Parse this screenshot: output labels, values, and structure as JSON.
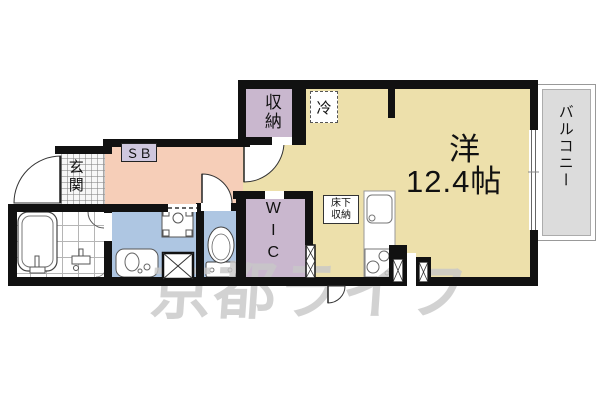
{
  "floorplan": {
    "watermark": "京都ライフ",
    "labels": {
      "entrance": "玄関",
      "shoe_box": "ＳＢ",
      "closet": "収納",
      "refrigerator": "冷",
      "main_room_name": "洋",
      "main_room_size": "12.4帖",
      "balcony": "バルコニー",
      "walk_in_closet": "WIC",
      "underfloor_storage_line1": "床下",
      "underfloor_storage_line2": "収納"
    },
    "colors": {
      "wall": "#111111",
      "main_floor": "#EDE0AB",
      "hall_floor": "#F6CEB8",
      "closet_floor": "#C9B7CE",
      "wet_floor": "#AEC6E2",
      "balcony_floor": "#DCDCDC",
      "shoe_box_fill": "#CFC7DE",
      "watermark_color": "#C8C8C8"
    }
  }
}
